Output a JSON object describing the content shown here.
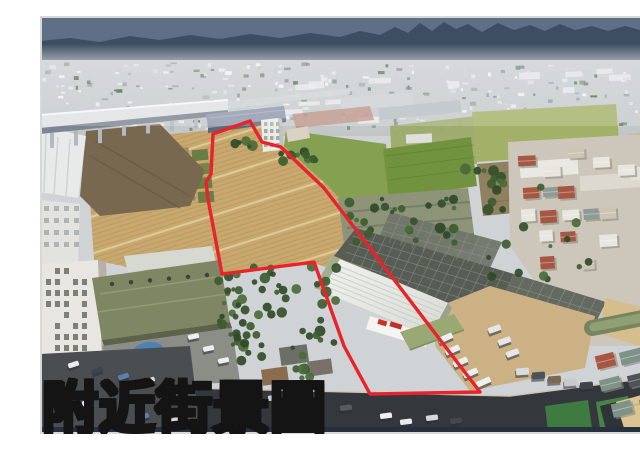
{
  "caption": {
    "text": "附近街景圖",
    "color": "#ffd60a",
    "outline_color": "#141414"
  },
  "annotation": {
    "label": "property-boundary",
    "boundary_color": "#e8232b",
    "boundary_stroke_width": "3.4",
    "boundary_points": "173,118 210,105 222,126 241,131 284,172 440,376 330,378 304,330 274,246 182,258 168,183 166,166 171,158"
  },
  "frame": {
    "border_color": "#d8d8d8"
  }
}
